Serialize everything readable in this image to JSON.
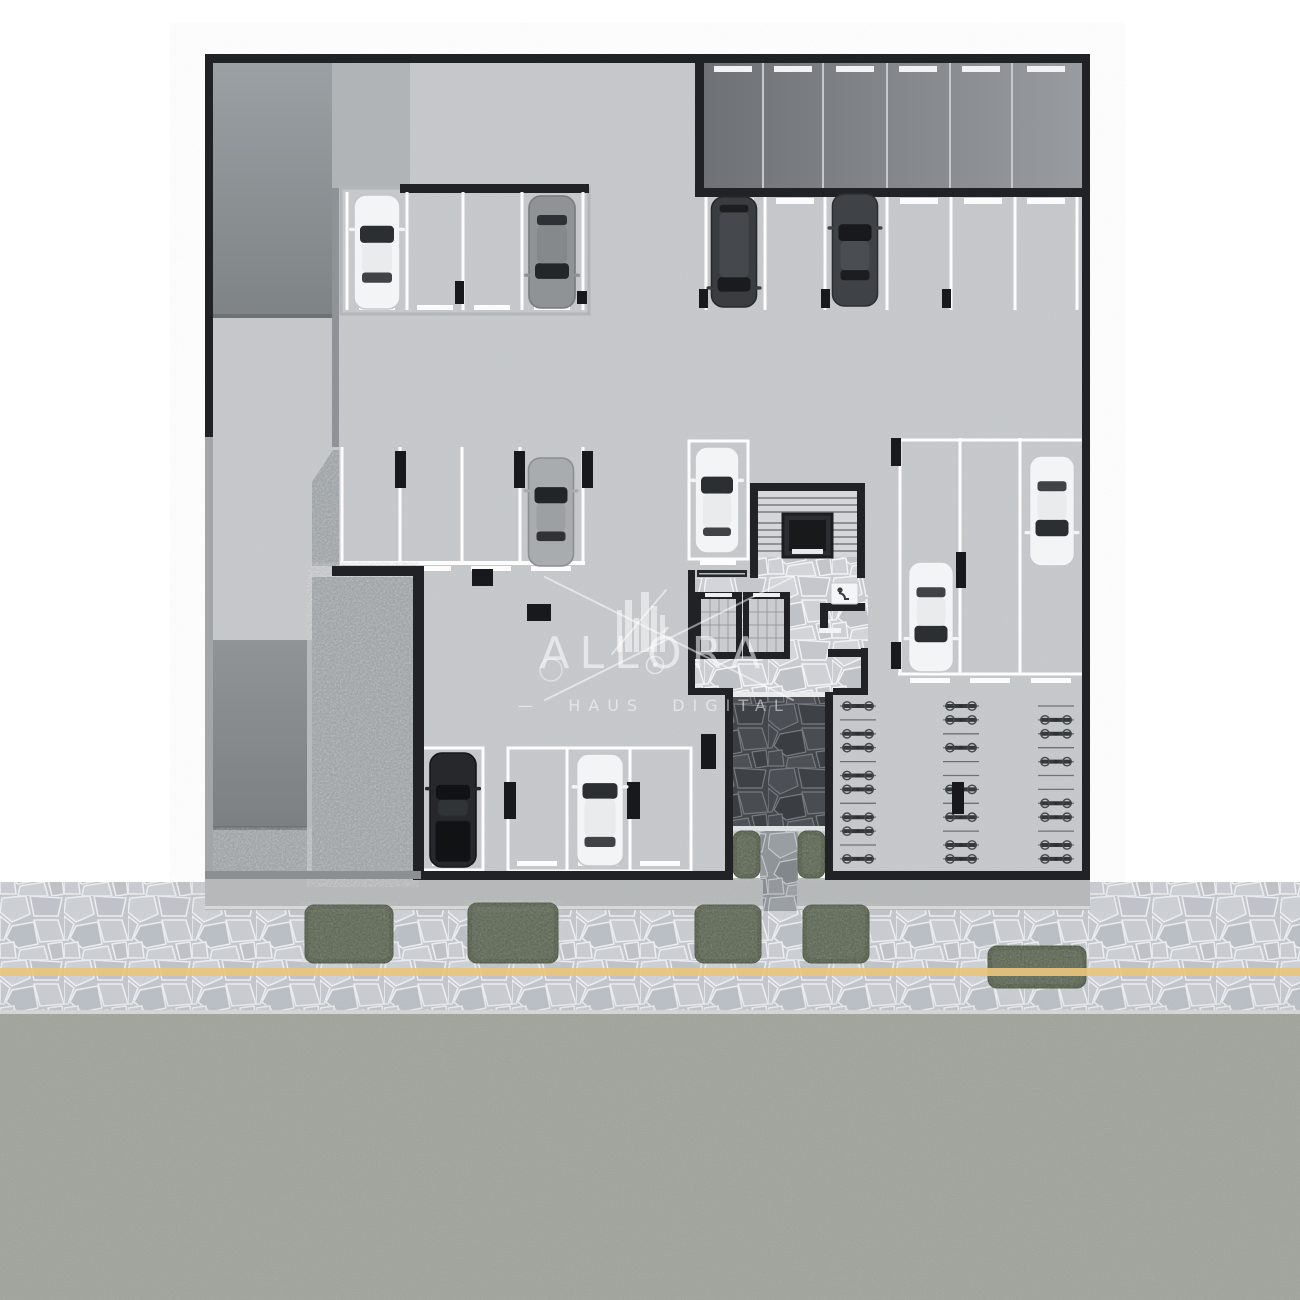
{
  "watermark": {
    "brand": "ALLÓRA",
    "tagline": "— HAUS DIGITAL"
  },
  "plan": {
    "level_type": "underground-parking-floor-plan",
    "stall_counts": {
      "upper_band_stalls": 6,
      "top_right_row_stalls": 6,
      "top_left_row_stalls": 4,
      "middle_row_stalls": 4,
      "right_column_stalls": 3,
      "stair_side_stalls": 1,
      "bottom_room_stalls": 4
    },
    "cars": [
      {
        "id": "car-1",
        "type": "sedan",
        "color": "white",
        "x": 377,
        "y": 252,
        "deg": 0,
        "w": 46,
        "l": 114
      },
      {
        "id": "car-2",
        "type": "suv",
        "color": "gray",
        "x": 552,
        "y": 252,
        "deg": 180,
        "w": 46,
        "l": 112
      },
      {
        "id": "car-3",
        "type": "van",
        "color": "darkvan",
        "x": 734,
        "y": 252,
        "deg": 180,
        "w": 45,
        "l": 110
      },
      {
        "id": "car-4",
        "type": "sedan",
        "color": "dark",
        "x": 855,
        "y": 250,
        "deg": 0,
        "w": 45,
        "l": 112
      },
      {
        "id": "car-5",
        "type": "sedan",
        "color": "silver",
        "x": 551,
        "y": 512,
        "deg": 0,
        "w": 45,
        "l": 108
      },
      {
        "id": "car-6",
        "type": "hatch",
        "color": "white",
        "x": 717,
        "y": 500,
        "deg": 0,
        "w": 44,
        "l": 106
      },
      {
        "id": "car-7",
        "type": "sedan",
        "color": "white",
        "x": 1052,
        "y": 511,
        "deg": 180,
        "w": 45,
        "l": 110
      },
      {
        "id": "car-8",
        "type": "sedan",
        "color": "white",
        "x": 931,
        "y": 617,
        "deg": 180,
        "w": 45,
        "l": 110
      },
      {
        "id": "car-9",
        "type": "pickup",
        "color": "black",
        "x": 453,
        "y": 810,
        "deg": 0,
        "w": 46,
        "l": 114
      },
      {
        "id": "car-10",
        "type": "suv",
        "color": "white",
        "x": 600,
        "y": 810,
        "deg": 0,
        "w": 47,
        "l": 112
      }
    ],
    "pillars": [
      {
        "x": 455,
        "y": 281,
        "w": 9,
        "h": 23
      },
      {
        "x": 577,
        "y": 291,
        "w": 10,
        "h": 13
      },
      {
        "x": 699,
        "y": 289,
        "w": 9,
        "h": 19
      },
      {
        "x": 821,
        "y": 289,
        "w": 9,
        "h": 19
      },
      {
        "x": 942,
        "y": 289,
        "w": 9,
        "h": 19
      },
      {
        "x": 395,
        "y": 451,
        "w": 11,
        "h": 37
      },
      {
        "x": 514,
        "y": 451,
        "w": 11,
        "h": 37
      },
      {
        "x": 582,
        "y": 451,
        "w": 11,
        "h": 37
      },
      {
        "x": 891,
        "y": 438,
        "w": 10,
        "h": 28
      },
      {
        "x": 956,
        "y": 552,
        "w": 10,
        "h": 36
      },
      {
        "x": 891,
        "y": 642,
        "w": 10,
        "h": 27
      },
      {
        "x": 472,
        "y": 569,
        "w": 21,
        "h": 17
      },
      {
        "x": 527,
        "y": 604,
        "w": 24,
        "h": 17
      },
      {
        "x": 504,
        "y": 782,
        "w": 12,
        "h": 37
      },
      {
        "x": 627,
        "y": 782,
        "w": 13,
        "h": 37
      },
      {
        "x": 952,
        "y": 782,
        "w": 12,
        "h": 32
      },
      {
        "x": 701,
        "y": 734,
        "w": 15,
        "h": 35
      }
    ],
    "bike_racks": {
      "rail_half": 18,
      "start_y": 706,
      "step": 13.9,
      "columns": [
        {
          "cx": 858,
          "slots": [
            1,
            0,
            1,
            1,
            0,
            1,
            1,
            0,
            1,
            1,
            0,
            1
          ]
        },
        {
          "cx": 961,
          "slots": [
            1,
            1,
            0,
            1,
            0,
            0,
            1,
            0,
            1,
            0,
            1,
            1
          ]
        },
        {
          "cx": 1056,
          "slots": [
            0,
            1,
            1,
            0,
            1,
            0,
            0,
            1,
            1,
            0,
            1,
            1
          ]
        }
      ]
    },
    "entrance_plants": [
      {
        "x": 733,
        "y": 831,
        "w": 27,
        "h": 47
      },
      {
        "x": 798,
        "y": 831,
        "w": 27,
        "h": 47
      }
    ]
  },
  "street": {
    "shrubs": [
      {
        "x": 305,
        "y": 905,
        "w": 88,
        "h": 58
      },
      {
        "x": 468,
        "y": 903,
        "w": 90,
        "h": 60
      },
      {
        "x": 695,
        "y": 905,
        "w": 66,
        "h": 58
      },
      {
        "x": 803,
        "y": 905,
        "w": 66,
        "h": 58
      },
      {
        "x": 988,
        "y": 946,
        "w": 98,
        "h": 42
      }
    ],
    "center_line_color": "#e9c47c",
    "sidewalk_band": {
      "top": 882,
      "bottom": 1012
    },
    "road_band": {
      "top": 1012,
      "bottom": 1300
    }
  },
  "colors": {
    "wall": "#202225",
    "floor": "#c6c9cb",
    "ramp_dark": "#7e8386",
    "gravel": "#9aa0a4",
    "asphalt": "#9fa39b",
    "accent_yellow": "#e9c47c",
    "plant_green": "#4f5945"
  }
}
